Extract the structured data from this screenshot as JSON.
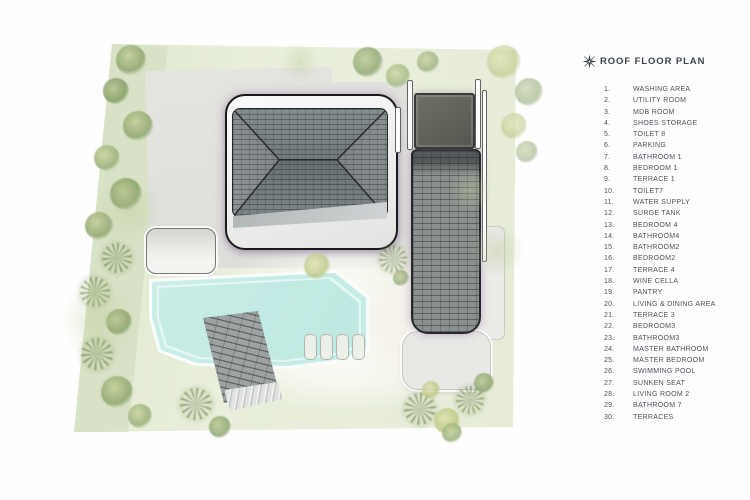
{
  "header": {
    "icon": "compass-rose-icon",
    "title": "ROOF FLOOR PLAN"
  },
  "legend": {
    "items": [
      {
        "num": "1.",
        "label": "WASHING AREA"
      },
      {
        "num": "2.",
        "label": "UTILITY ROOM"
      },
      {
        "num": "3.",
        "label": "MDB ROOM"
      },
      {
        "num": "4.",
        "label": "SHOES STORAGE"
      },
      {
        "num": "5.",
        "label": "TOILET 8"
      },
      {
        "num": "6.",
        "label": "PARKING"
      },
      {
        "num": "7.",
        "label": "BATHROOM 1"
      },
      {
        "num": "8.",
        "label": "BEDROOM 1"
      },
      {
        "num": "9.",
        "label": "TERRACE 1"
      },
      {
        "num": "10.",
        "label": "TOILET7"
      },
      {
        "num": "11.",
        "label": "WATER SUPPLY"
      },
      {
        "num": "12.",
        "label": "SURGE TANK"
      },
      {
        "num": "13.",
        "label": "BEDROOM 4"
      },
      {
        "num": "14.",
        "label": "BATHROOM4"
      },
      {
        "num": "15.",
        "label": "BATHROOM2"
      },
      {
        "num": "16.",
        "label": "BEDROOM2"
      },
      {
        "num": "17.",
        "label": "TERRACE 4"
      },
      {
        "num": "18.",
        "label": "WINE CELLA"
      },
      {
        "num": "19.",
        "label": "PANTRY"
      },
      {
        "num": "20.",
        "label": "LIVING & DINING AREA"
      },
      {
        "num": "21.",
        "label": "TERRACE 3"
      },
      {
        "num": "22.",
        "label": "BEDROOM3"
      },
      {
        "num": "23.",
        "label": "BATHROOM3"
      },
      {
        "num": "24.",
        "label": "MASTER BATHROOM"
      },
      {
        "num": "25.",
        "label": "MASTER BEDROOM"
      },
      {
        "num": "26.",
        "label": "SWIMMING POOL"
      },
      {
        "num": "27.",
        "label": "SUNKEN SEAT"
      },
      {
        "num": "28.",
        "label": "LIVING ROOM 2"
      },
      {
        "num": "29.",
        "label": "BATHROOM 7"
      },
      {
        "num": "30.",
        "label": "TERRACES"
      }
    ]
  },
  "palette": {
    "site_green": "#e6ecd8",
    "tree_green": "#93a974",
    "paving_gray": "#e2e2df",
    "roof_tile_gray": "#6e7678",
    "roof_frame_white": "#f5f5f5",
    "deck_dark": "#5f6259",
    "pool_cyan": "#c4ebe5",
    "walkway_gray": "#9da3a2",
    "outline_dark": "#191919",
    "shadow_purple": "#9b7daa",
    "text_slate": "#4a525b"
  },
  "plan": {
    "loungers_count": 4,
    "trees": [
      [
        131,
        60,
        30,
        "g2"
      ],
      [
        116,
        91,
        26,
        "g3"
      ],
      [
        138,
        126,
        30,
        "g2"
      ],
      [
        107,
        158,
        26,
        "g1"
      ],
      [
        126,
        194,
        32,
        "g3"
      ],
      [
        99,
        226,
        28,
        "g2"
      ],
      [
        117,
        258,
        30,
        "palm"
      ],
      [
        95,
        292,
        30,
        "palm"
      ],
      [
        119,
        322,
        26,
        "g3"
      ],
      [
        97,
        354,
        32,
        "palm"
      ],
      [
        117,
        392,
        32,
        "g2"
      ],
      [
        140,
        416,
        24,
        "g1"
      ],
      [
        368,
        62,
        30,
        "g3",
        0.75
      ],
      [
        398,
        76,
        24,
        "g1",
        0.75
      ],
      [
        428,
        62,
        22,
        "g2",
        0.7
      ],
      [
        504,
        62,
        34,
        "g4",
        0.6
      ],
      [
        529,
        92,
        28,
        "g3",
        0.55
      ],
      [
        514,
        126,
        26,
        "g4",
        0.6
      ],
      [
        527,
        152,
        22,
        "g3",
        0.5
      ],
      [
        317,
        266,
        26,
        "g4",
        0.8
      ],
      [
        393,
        259,
        28,
        "palm",
        0.85
      ],
      [
        401,
        278,
        16,
        "g3",
        0.7
      ],
      [
        196,
        404,
        32,
        "palm"
      ],
      [
        220,
        427,
        22,
        "g3",
        0.8
      ],
      [
        420,
        409,
        32,
        "palm"
      ],
      [
        447,
        421,
        26,
        "g4",
        0.85
      ],
      [
        470,
        400,
        28,
        "palm",
        0.9
      ],
      [
        484,
        383,
        20,
        "g3",
        0.8
      ],
      [
        452,
        433,
        20,
        "g2",
        0.8
      ],
      [
        431,
        390,
        18,
        "g4",
        0.8
      ],
      [
        128,
        210,
        70,
        "patch"
      ],
      [
        100,
        320,
        80,
        "patch"
      ],
      [
        497,
        250,
        55,
        "patch"
      ],
      [
        470,
        190,
        45,
        "patch"
      ],
      [
        300,
        62,
        40,
        "patch"
      ]
    ]
  }
}
